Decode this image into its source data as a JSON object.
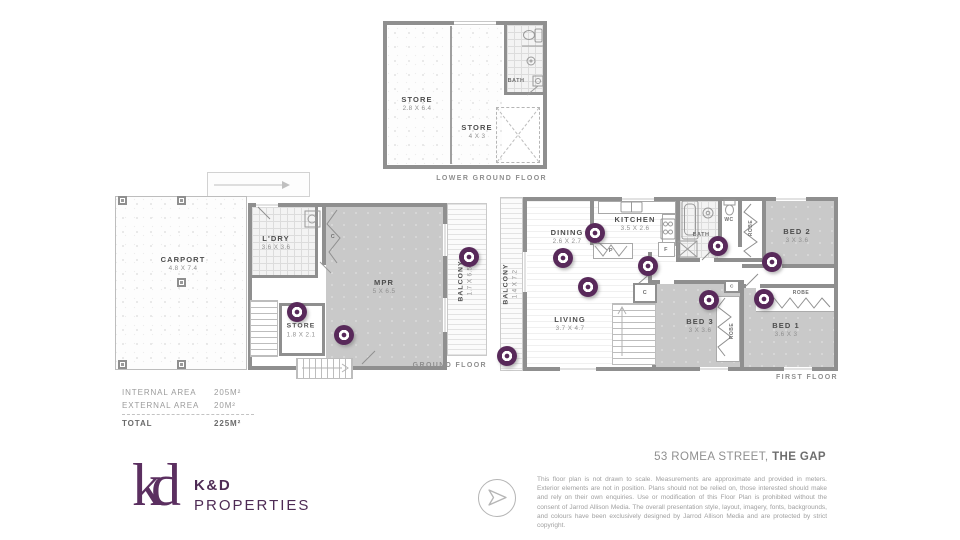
{
  "property": {
    "address_prefix": "53 ROMEA STREET,",
    "address_suffix": " THE GAP"
  },
  "branding": {
    "monogram": "kd",
    "name_top": "K&D",
    "name_bottom": "PROPERTIES"
  },
  "footer": {
    "disclaimer": "This floor plan is not drawn to scale. Measurements are approximate and provided in meters. Exterior elements are not in position. Plans should not be relied on, those interested should make and rely on their own enquiries. Use or modification of this Floor Plan is prohibited without the consent of Jarrod Allison Media. The overall presentation style, layout, imagery, fonts, backgrounds, and colours have been exclusively designed by Jarrod Allison Media and are protected by strict copyright."
  },
  "areas": {
    "internal_label": "INTERNAL AREA",
    "internal_value": "205M²",
    "external_label": "EXTERNAL AREA",
    "external_value": "20M²",
    "total_label": "TOTAL",
    "total_value": "225M²"
  },
  "floors": {
    "lower_ground": {
      "title": "LOWER GROUND FLOOR",
      "store1_name": "STORE",
      "store1_dims": "2.8 X 6.4",
      "store2_name": "STORE",
      "store2_dims": "4 X 3",
      "bath": "BATH"
    },
    "ground": {
      "title": "GROUND FLOOR",
      "carport_name": "CARPORT",
      "carport_dims": "4.8 X 7.4",
      "ldry_name": "L'DRY",
      "ldry_dims": "3.6 X 3.6",
      "mpr_name": "MPR",
      "mpr_dims": "5 X 6.5",
      "store_name": "STORE",
      "store_dims": "1.8 X 2.1",
      "balcony_name": "BALCONY",
      "balcony_dims": "1.7 X 6.5",
      "closet": "C"
    },
    "first": {
      "title": "FIRST FLOOR",
      "balcony_name": "BALCONY",
      "balcony_dims": "1.4 X 7.2",
      "dining_name": "DINING",
      "dining_dims": "2.6 X 2.7",
      "kitchen_name": "KITCHEN",
      "kitchen_dims": "3.5 X 2.6",
      "living_name": "LIVING",
      "living_dims": "3.7 X 4.7",
      "bath": "BATH",
      "wc": "WC",
      "robe": "ROBE",
      "pantry": "P",
      "fridge": "F",
      "closet": "C",
      "bed1_name": "BED 1",
      "bed1_dims": "3.6 X 3",
      "bed2_name": "BED 2",
      "bed2_dims": "3 X 3.6",
      "bed3_name": "BED 3",
      "bed3_dims": "3 X 3.6"
    }
  }
}
